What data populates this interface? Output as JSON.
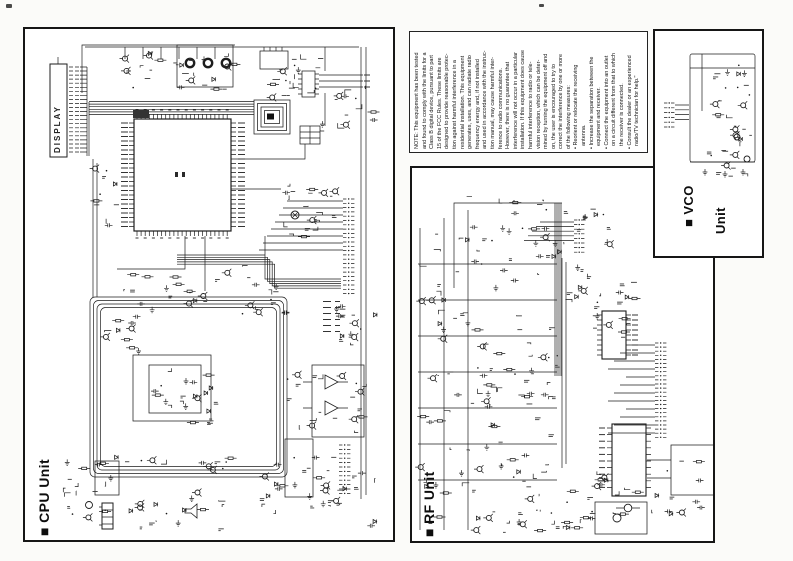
{
  "window": {
    "background": "#fbfbf9",
    "ink": "#1d1d1d"
  },
  "cpu_unit": {
    "label": "■ CPU Unit",
    "display_label": "DISPLAY"
  },
  "rf_unit": {
    "label": "■ RF Unit"
  },
  "vco_unit": {
    "label_line1": "■ VCO",
    "label_line2": "Unit"
  },
  "fcc_notice": {
    "text": "NOTE: This equipment has been tested\nand found to comply with the limits for a\nClass B digital device, pursuant to part\n15 of the FCC Rules. These limits are\ndesigned to provide reasonable protec-\ntion against harmful interference in a\nresidential installation. This equipment\ngenerates, uses, and can radiate radio\nfrequency energy and, if not installed\nand used in accordance with the instruc-\ntion manual, may cause harmful inter-\nference to radio communications.\nHowever, there is no guarantee that\ninterference will not occur in a particular\ninstallation. If this equipment does cause\nharmful interference to radio or tele-\nvision reception, which can be deter-\nmined by turning the equipment off and\non, the user is encouraged to try to\ncorrect the interference by one or more\nof the following measures:\n• Reorient or relocate the receiving\n  antenna.\n• Increase the separation between the\n  equipment and receiver.\n• Connect the equipment into an outlet\n  on a circuit different from that to which\n  the receiver is connected.\n• Consult the dealer or an experienced\n  radio/TV technician for help.\""
  }
}
